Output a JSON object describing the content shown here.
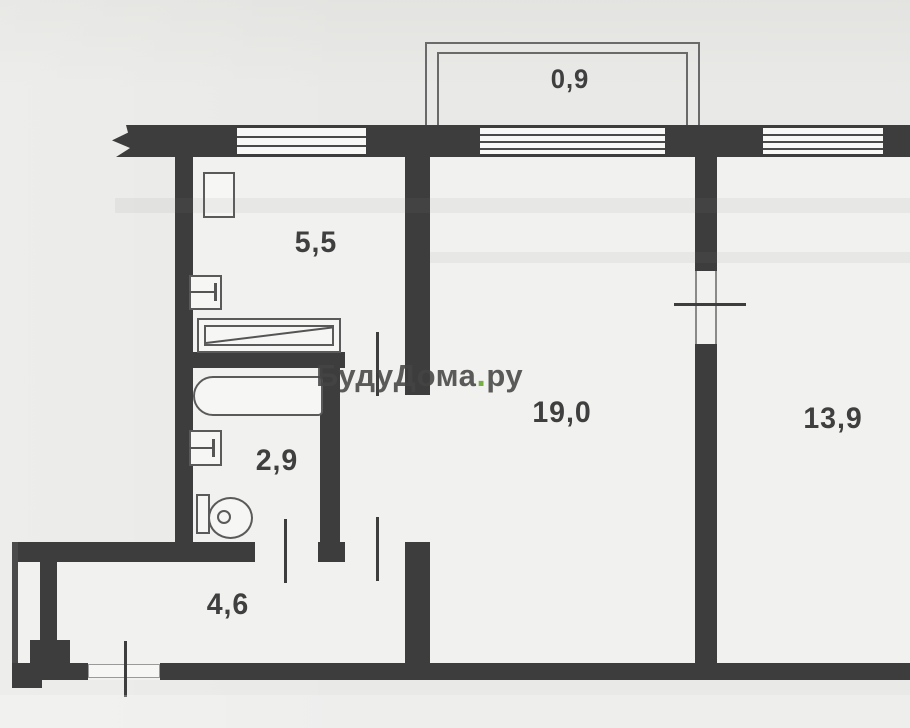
{
  "document": {
    "kind": "apartment-floor-plan-scan"
  },
  "labels": {
    "balcony": "0,9",
    "kitchen": "5,5",
    "bathroom": "2,9",
    "hallway": "4,6",
    "living": "19,0",
    "room2": "13,9"
  },
  "watermark": {
    "brand": "БудуДома",
    "dot": ".",
    "tld": "ру",
    "dot_color": "#76b043",
    "text_color": "#444444"
  },
  "colors": {
    "wall": "#3d3d3d",
    "background": "#e9e9e7",
    "interior": "#f1f1ef",
    "fixture_line": "#5a5a5a"
  }
}
